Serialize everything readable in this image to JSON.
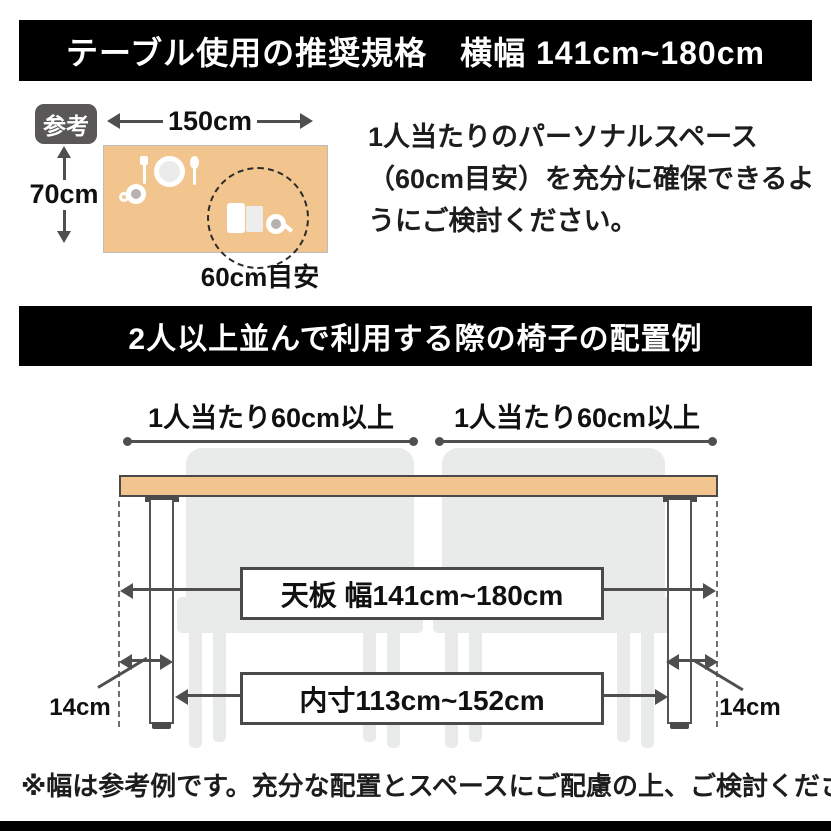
{
  "colors": {
    "banner_bg": "#000000",
    "banner_text": "#ffffff",
    "wood": "#f2c58e",
    "line": "#4f4f4f",
    "chair": "#e9ebea",
    "badge_bg": "#595757",
    "ink": "#111111",
    "dish": "#ffffff"
  },
  "banner1": {
    "title": "テーブル使用の推奨規格　横幅 141cm~180cm"
  },
  "reference": {
    "badge_label": "参考",
    "table_width_label": "150cm",
    "table_depth_label": "70cm",
    "personal_space_label": "60cm目安",
    "note": "1人当たりのパーソナルスペース（60cm目安）を充分に確保できるようにご検討ください。"
  },
  "banner2": {
    "title": "2人以上並んで利用する際の椅子の配置例"
  },
  "chair_layout": {
    "per_person_left": "1人当たり60cm以上",
    "per_person_right": "1人当たり60cm以上",
    "tabletop_width": "天板 幅141cm~180cm",
    "inner_width": "内寸113cm~152cm",
    "leg_inset_left": "14cm",
    "leg_inset_right": "14cm"
  },
  "footer": {
    "note": "※幅は参考例です。充分な配置とスペースにご配慮の上、ご検討ください。"
  }
}
